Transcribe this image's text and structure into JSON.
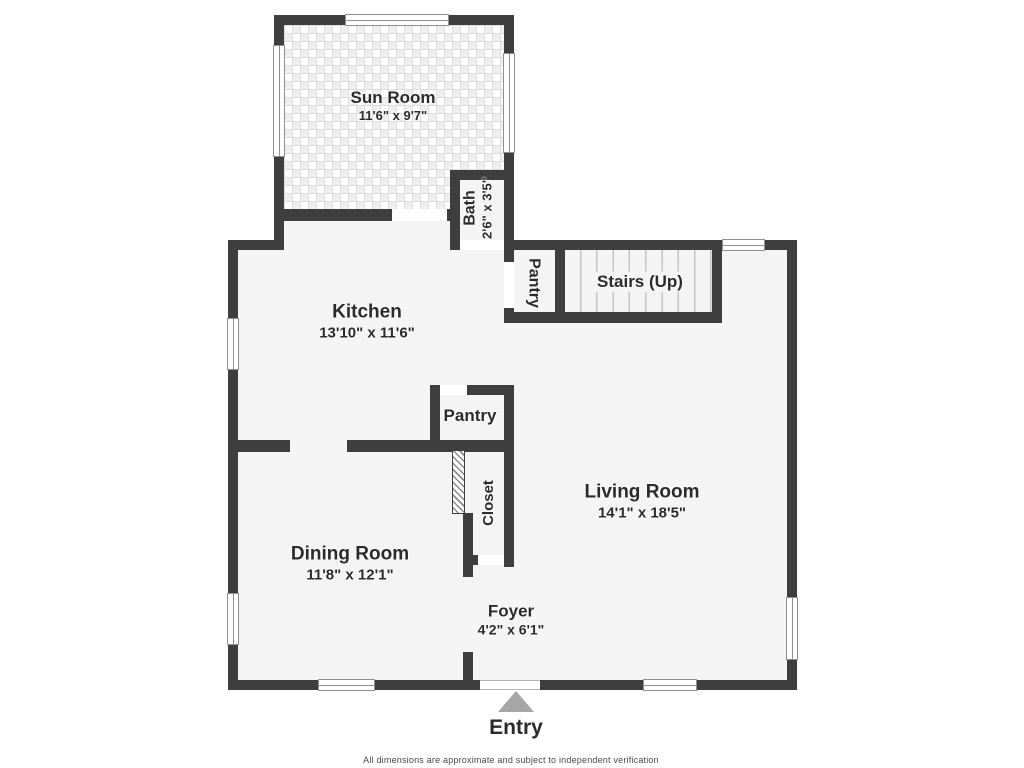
{
  "colors": {
    "wall": "#3e3e3e",
    "floor": "#f4f4f4",
    "window_line": "#909090",
    "opening": "#ffffff",
    "stair_tread": "#c5c5c5",
    "entry_arrow": "#a6a6a6",
    "label_text": "#2b2b2b",
    "disclaimer_text": "#4a4a4a"
  },
  "rooms": {
    "sun_room": {
      "name": "Sun Room",
      "dims": "11'6\" x 9'7\""
    },
    "bath": {
      "name": "Bath",
      "dims": "2'6\" x 3'5\""
    },
    "pantry_upper": {
      "name": "Pantry"
    },
    "stairs": {
      "name": "Stairs (Up)"
    },
    "kitchen": {
      "name": "Kitchen",
      "dims": "13'10\" x 11'6\""
    },
    "pantry_lower": {
      "name": "Pantry"
    },
    "closet": {
      "name": "Closet"
    },
    "living_room": {
      "name": "Living Room",
      "dims": "14'1\" x 18'5\""
    },
    "dining_room": {
      "name": "Dining Room",
      "dims": "11'8\" x 12'1\""
    },
    "foyer": {
      "name": "Foyer",
      "dims": "4'2\" x 6'1\""
    }
  },
  "entry": {
    "label": "Entry"
  },
  "footer": {
    "disclaimer": "All dimensions are approximate and subject to independent verification"
  }
}
